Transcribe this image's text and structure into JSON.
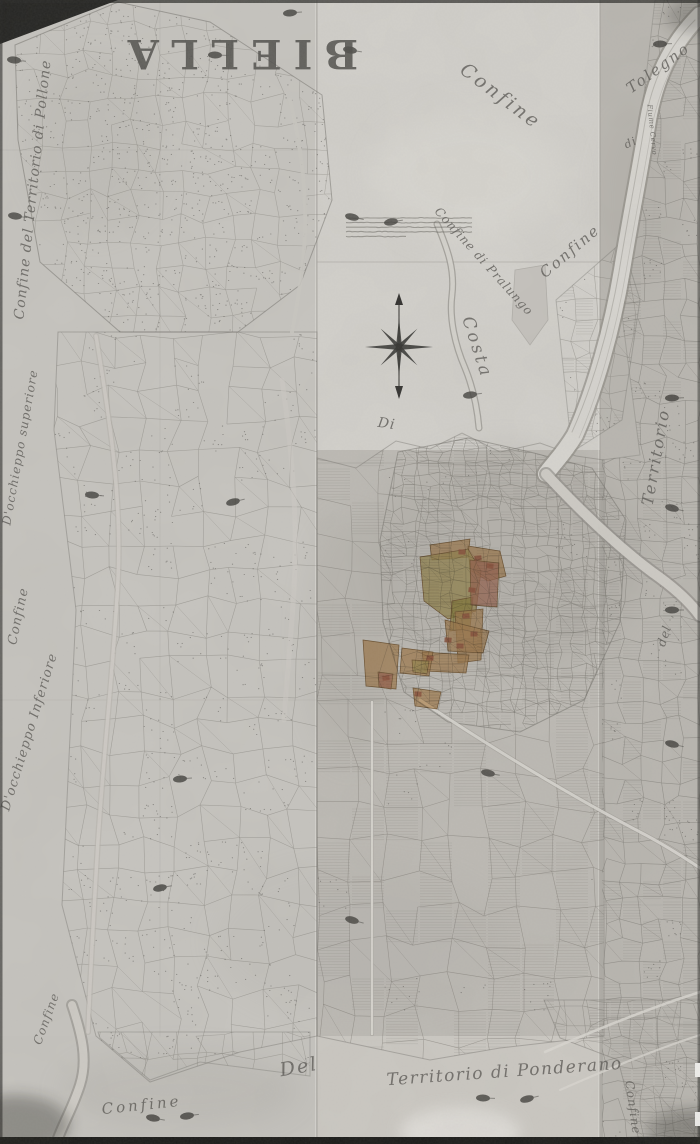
{
  "map": {
    "description": "Antique hand-drawn cadastral map of the territory of Biella with neighbouring confines, town centre highlighted in colour",
    "title": {
      "text": "BIELLA"
    },
    "labels": [
      {
        "name": "map-title-biella",
        "text": "BIELLA",
        "x": 237,
        "y": 40,
        "rot": 180,
        "size": 40,
        "ls": 12,
        "cls": "title"
      },
      {
        "name": "label-confine-top-middle",
        "text": "Confine",
        "x": 497,
        "y": 101,
        "rot": 37,
        "size": 19,
        "ls": 3
      },
      {
        "name": "label-confine-territorio-pollone",
        "text": "Confine del Territorio di Pollone",
        "x": 37,
        "y": 190,
        "rot": -84,
        "size": 14,
        "ls": 1
      },
      {
        "name": "label-occhieppo-superiore",
        "text": "D'occhieppo superiore",
        "x": 24,
        "y": 448,
        "rot": -80,
        "size": 12,
        "ls": 1
      },
      {
        "name": "label-confine-left-mid",
        "text": "Confine",
        "x": 22,
        "y": 617,
        "rot": -78,
        "size": 13,
        "ls": 1
      },
      {
        "name": "label-occhieppo-inferiore",
        "text": "D'occhieppo Inferiore",
        "x": 33,
        "y": 733,
        "rot": -73,
        "size": 13,
        "ls": 1
      },
      {
        "name": "label-confine-left-bottom",
        "text": "Confine",
        "x": 50,
        "y": 1020,
        "rot": -70,
        "size": 12,
        "ls": 1
      },
      {
        "name": "label-confine-di-pralungo",
        "text": "Confine di Pralungo",
        "x": 481,
        "y": 264,
        "rot": 48,
        "size": 12,
        "ls": 1
      },
      {
        "name": "label-confine-upper-right",
        "text": "Confine",
        "x": 573,
        "y": 255,
        "rot": -40,
        "size": 15,
        "ls": 2
      },
      {
        "name": "label-costa",
        "text": "Costa",
        "x": 472,
        "y": 349,
        "rot": 72,
        "size": 17,
        "ls": 3
      },
      {
        "name": "label-di-middle",
        "text": "Di",
        "x": 386,
        "y": 428,
        "rot": 8,
        "size": 14,
        "ls": 1
      },
      {
        "name": "label-tolegno",
        "text": "Tolegno",
        "x": 661,
        "y": 72,
        "rot": -36,
        "size": 15,
        "ls": 2
      },
      {
        "name": "label-di-tolegno",
        "text": "di",
        "x": 632,
        "y": 146,
        "rot": -25,
        "size": 11,
        "ls": 1
      },
      {
        "name": "label-fiume-cervo",
        "text": "Fiume Cervo",
        "x": 650,
        "y": 130,
        "rot": 84,
        "size": 7,
        "ls": 0.5
      },
      {
        "name": "label-territorio-right",
        "text": "Territorio",
        "x": 661,
        "y": 458,
        "rot": -80,
        "size": 16,
        "ls": 2
      },
      {
        "name": "label-del-right",
        "text": "del",
        "x": 668,
        "y": 637,
        "rot": -72,
        "size": 12,
        "ls": 1
      },
      {
        "name": "label-del-bottom",
        "text": "Del",
        "x": 300,
        "y": 1073,
        "rot": -10,
        "size": 19,
        "ls": 2
      },
      {
        "name": "label-territorio-ponderano",
        "text": "Territorio di Ponderano",
        "x": 505,
        "y": 1077,
        "rot": -4,
        "size": 17,
        "ls": 1.5
      },
      {
        "name": "label-confine-bottom-right",
        "text": "Confine",
        "x": 629,
        "y": 1108,
        "rot": 82,
        "size": 12,
        "ls": 1
      },
      {
        "name": "label-confine-bottom-left",
        "text": "Confine",
        "x": 142,
        "y": 1110,
        "rot": -6,
        "size": 15,
        "ls": 3
      }
    ],
    "compass": {
      "x": 399,
      "y": 347
    },
    "note_block": {
      "x": 346,
      "y": 218,
      "width": 132,
      "lines": 5
    },
    "stamps": [
      [
        14,
        60
      ],
      [
        215,
        55
      ],
      [
        290,
        13
      ],
      [
        350,
        50
      ],
      [
        660,
        44
      ],
      [
        15,
        216
      ],
      [
        352,
        217
      ],
      [
        391,
        222
      ],
      [
        470,
        395
      ],
      [
        672,
        398
      ],
      [
        92,
        495
      ],
      [
        233,
        502
      ],
      [
        672,
        508
      ],
      [
        672,
        610
      ],
      [
        180,
        779
      ],
      [
        488,
        773
      ],
      [
        160,
        888
      ],
      [
        352,
        920
      ],
      [
        672,
        744
      ],
      [
        483,
        1098
      ],
      [
        527,
        1099
      ],
      [
        153,
        1118
      ],
      [
        187,
        1116
      ]
    ],
    "colors": {
      "paper_light": "#d4d2cc",
      "paper_mid": "#c6c4be",
      "paper_dark": "#b7b4ae",
      "ink": "#55534f",
      "ink_faint": "#7a7771",
      "highlight_tan": "#d4a365",
      "highlight_yellow": "#c6b266",
      "highlight_olive": "#b3a64e",
      "highlight_red": "#c9836a",
      "highlight_deep_red": "#b96a4e",
      "highlight_stroke": "#8f6b3e"
    }
  }
}
